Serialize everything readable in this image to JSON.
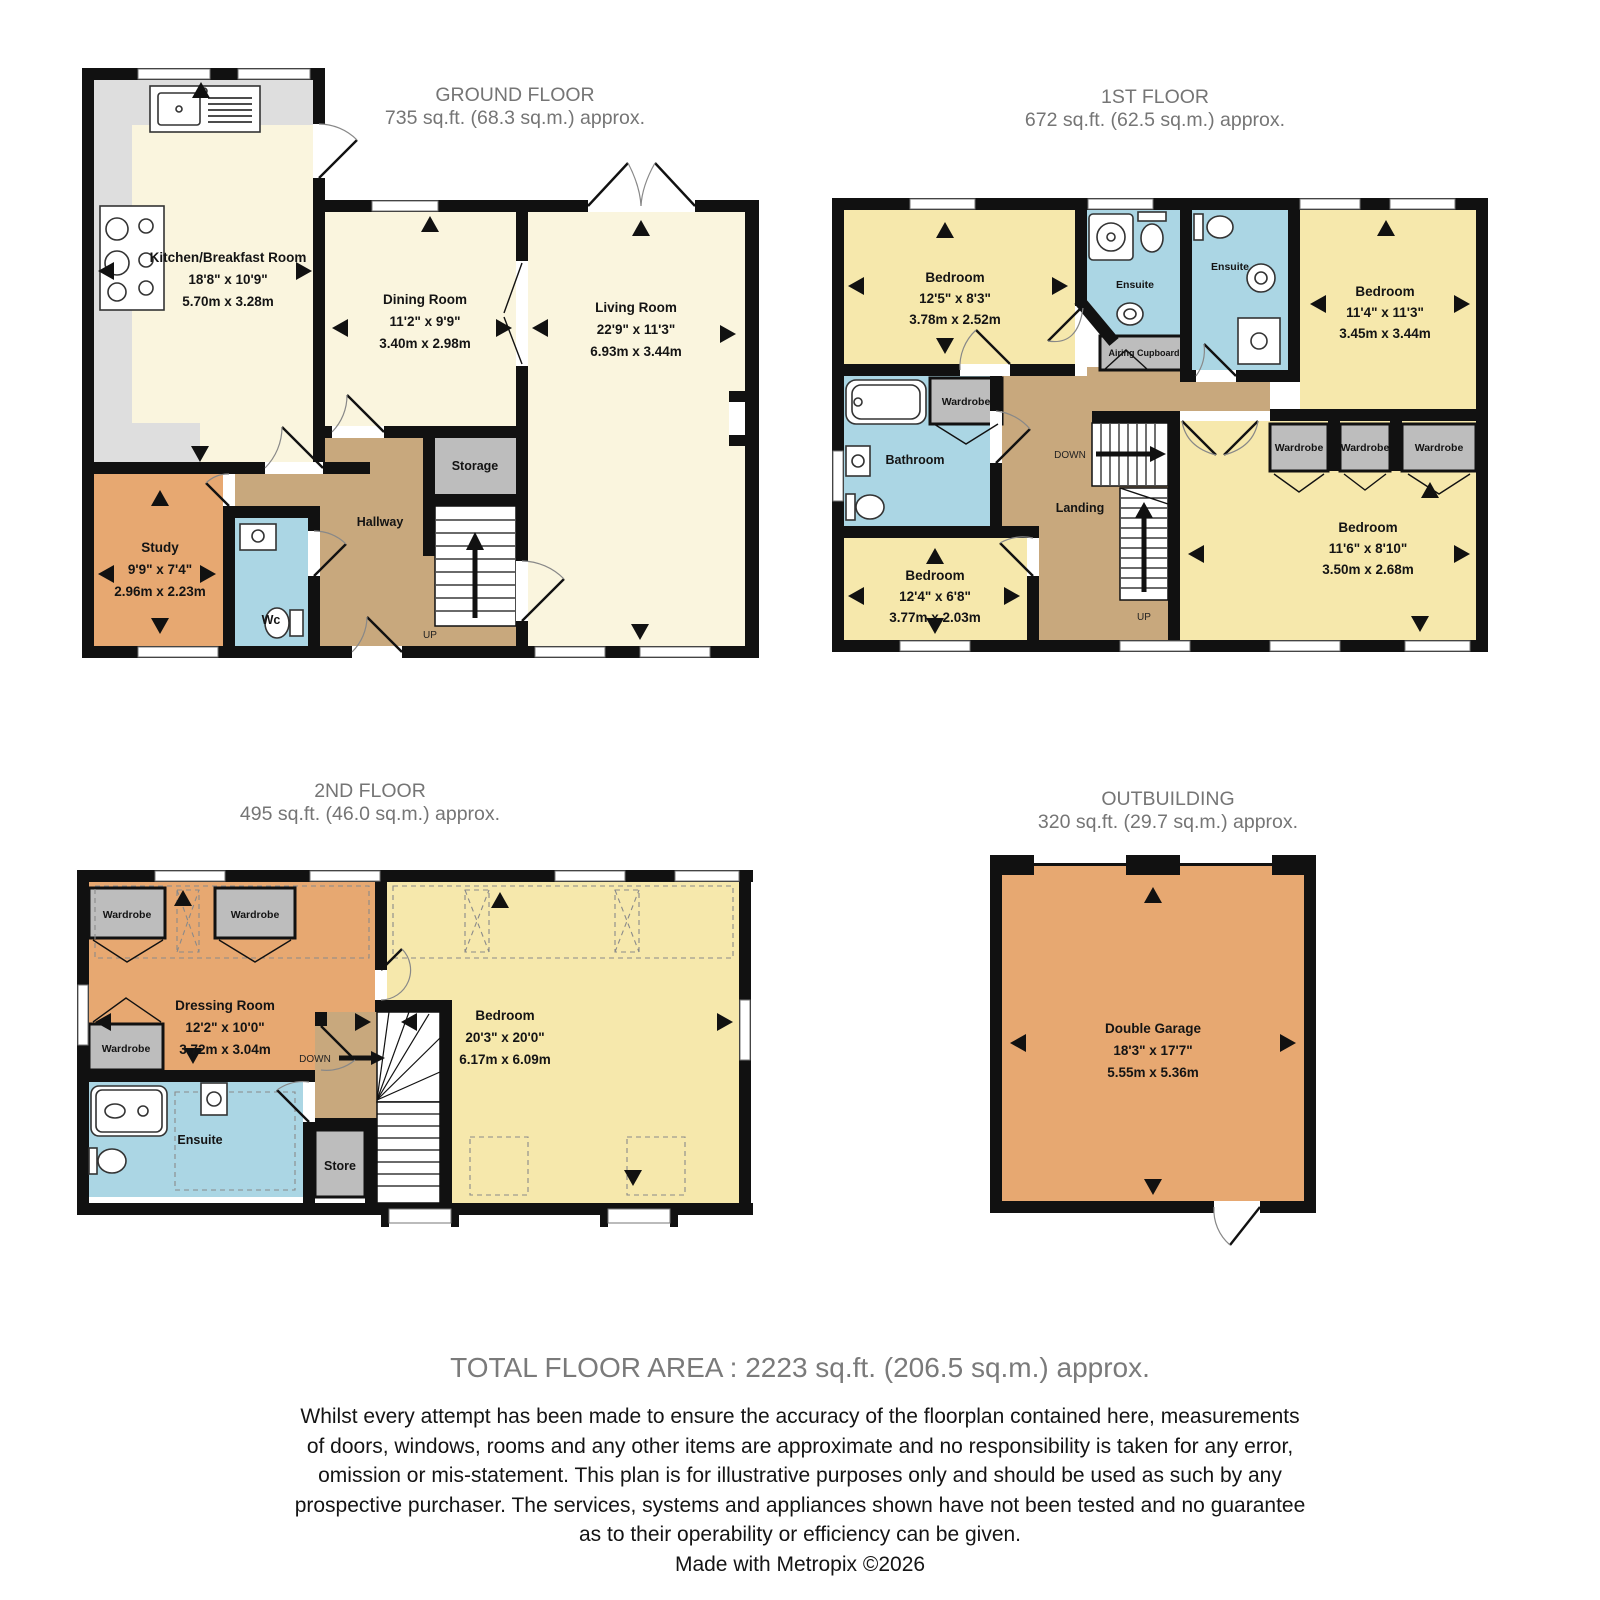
{
  "ground_floor": {
    "title": "GROUND FLOOR",
    "area": "735 sq.ft. (68.3 sq.m.) approx.",
    "rooms": {
      "kitchen": {
        "name": "Kitchen/Breakfast Room",
        "imperial": "18'8\" x 10'9\"",
        "metric": "5.70m x 3.28m"
      },
      "dining": {
        "name": "Dining Room",
        "imperial": "11'2\" x 9'9\"",
        "metric": "3.40m x 2.98m"
      },
      "living": {
        "name": "Living Room",
        "imperial": "22'9\" x 11'3\"",
        "metric": "6.93m x 3.44m"
      },
      "study": {
        "name": "Study",
        "imperial": "9'9\" x 7'4\"",
        "metric": "2.96m x 2.23m"
      },
      "wc": {
        "name": "Wc"
      },
      "hallway": {
        "name": "Hallway"
      },
      "storage": {
        "name": "Storage"
      }
    },
    "stairs_up": "UP"
  },
  "first_floor": {
    "title": "1ST FLOOR",
    "area": "672 sq.ft. (62.5 sq.m.) approx.",
    "rooms": {
      "bedroom1": {
        "name": "Bedroom",
        "imperial": "12'5\" x 8'3\"",
        "metric": "3.78m x 2.52m"
      },
      "bedroom2": {
        "name": "Bedroom",
        "imperial": "11'4\" x 11'3\"",
        "metric": "3.45m x 3.44m"
      },
      "bedroom3": {
        "name": "Bedroom",
        "imperial": "11'6\" x 8'10\"",
        "metric": "3.50m x 2.68m"
      },
      "bedroom4": {
        "name": "Bedroom",
        "imperial": "12'4\" x 6'8\"",
        "metric": "3.77m x 2.03m"
      },
      "ensuite1": {
        "name": "Ensuite"
      },
      "ensuite2": {
        "name": "Ensuite"
      },
      "bathroom": {
        "name": "Bathroom"
      },
      "landing": {
        "name": "Landing"
      },
      "airing_cupboard": {
        "name": "Airing Cupboard"
      },
      "wardrobe1": {
        "name": "Wardrobe"
      },
      "wardrobe2": {
        "name": "Wardrobe"
      },
      "wardrobe3": {
        "name": "Wardrobe"
      },
      "wardrobe4": {
        "name": "Wardrobe"
      }
    },
    "stairs_down": "DOWN",
    "stairs_up": "UP"
  },
  "second_floor": {
    "title": "2ND FLOOR",
    "area": "495 sq.ft. (46.0 sq.m.) approx.",
    "rooms": {
      "dressing": {
        "name": "Dressing Room",
        "imperial": "12'2\" x 10'0\"",
        "metric": "3.72m x 3.04m"
      },
      "bedroom": {
        "name": "Bedroom",
        "imperial": "20'3\" x 20'0\"",
        "metric": "6.17m x 6.09m"
      },
      "ensuite": {
        "name": "Ensuite"
      },
      "store": {
        "name": "Store"
      },
      "wardrobe1": {
        "name": "Wardrobe"
      },
      "wardrobe2": {
        "name": "Wardrobe"
      },
      "wardrobe3": {
        "name": "Wardrobe"
      }
    },
    "stairs_down": "DOWN"
  },
  "outbuilding": {
    "title": "OUTBUILDING",
    "area": "320 sq.ft. (29.7 sq.m.) approx.",
    "rooms": {
      "garage": {
        "name": "Double Garage",
        "imperial": "18'3\" x 17'7\"",
        "metric": "5.55m x 5.36m"
      }
    }
  },
  "footer": {
    "total_area": "TOTAL FLOOR AREA : 2223 sq.ft. (206.5 sq.m.) approx.",
    "disclaimer_lines": [
      "Whilst every attempt has been made to ensure the accuracy of the floorplan contained here, measurements",
      "of doors, windows, rooms and any other items are approximate and no responsibility is taken for any error,",
      "omission or mis-statement. This plan is for illustrative purposes only and should be used as such by any",
      "prospective purchaser. The services, systems and appliances shown have not been tested and no guarantee",
      "as to their operability or efficiency can be given.",
      "Made with Metropix ©2026"
    ]
  },
  "colors": {
    "wall": "#111111",
    "cream_room": "#FAF5DE",
    "yellow_room": "#F6E8AC",
    "orange_room": "#E7A871",
    "wet_room_blue": "#ABD6E4",
    "hall_brown": "#C8A87D",
    "gray_room": "#BDBDBD",
    "counter_gray": "#DEDEDE",
    "title_gray": "#757575"
  }
}
